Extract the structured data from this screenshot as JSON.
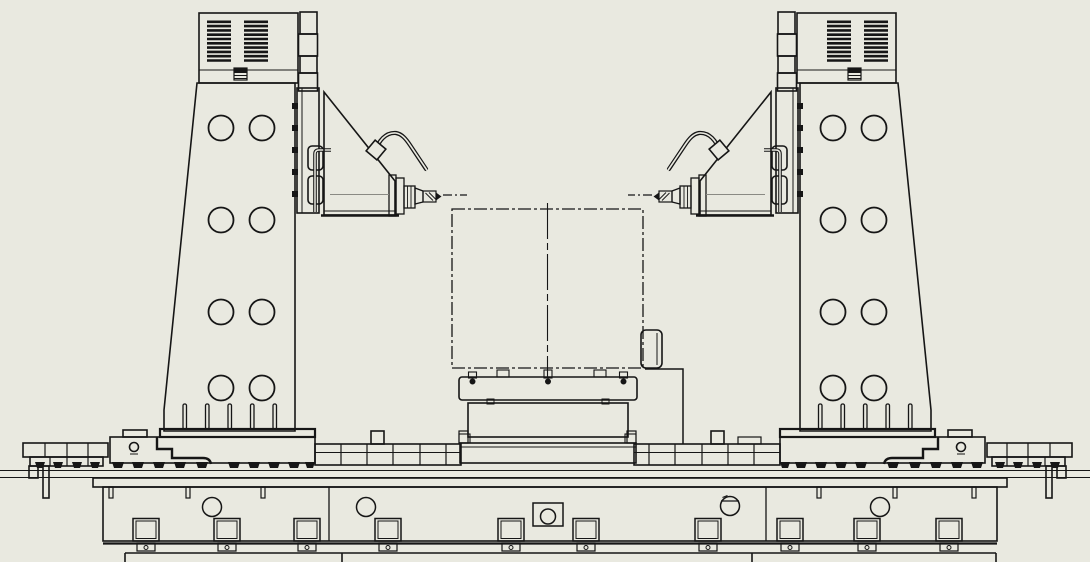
{
  "window": {
    "width": 1090,
    "height": 562,
    "background_color": "#e9e9e0",
    "line_color": "#161616",
    "centerline_color": "#8a8a84"
  },
  "scene": {
    "type": "cad-line-drawing",
    "view": "front elevation",
    "subject": "twin-column horizontal spindle machine with center pallet fixture on long bed",
    "symmetry_axis_x": 547.5,
    "linetypes": {
      "workpiece_envelope": "phantom dash-dot",
      "spindle_axis": "center dash-dot"
    },
    "components": {
      "columns": {
        "count": 2,
        "vent_groups_per_column": 2,
        "vent_slats_per_group": 10,
        "face_holes_rows": 4,
        "face_holes_columns": 2,
        "base_pins_per_column": 5
      },
      "spindle_heads": {
        "count": 2,
        "orientation": "horizontal, facing machine center",
        "tool": "drill bit",
        "cable": "curved hose loop on each head"
      },
      "workpiece_envelope": {
        "shape": "rectangle with vertical centerline",
        "side_bracket": "right edge clamp block"
      },
      "pallet_stack": {
        "parts": [
          "pallet plate",
          "riser block",
          "base platform"
        ],
        "pallet_bolts": 3
      },
      "bed": {
        "front_sections": 3,
        "front_pads": 10,
        "round_holes": 4,
        "center_port": "square plate with round hole",
        "foot_tabs": 10,
        "end_stop_blocks": 2
      }
    }
  }
}
